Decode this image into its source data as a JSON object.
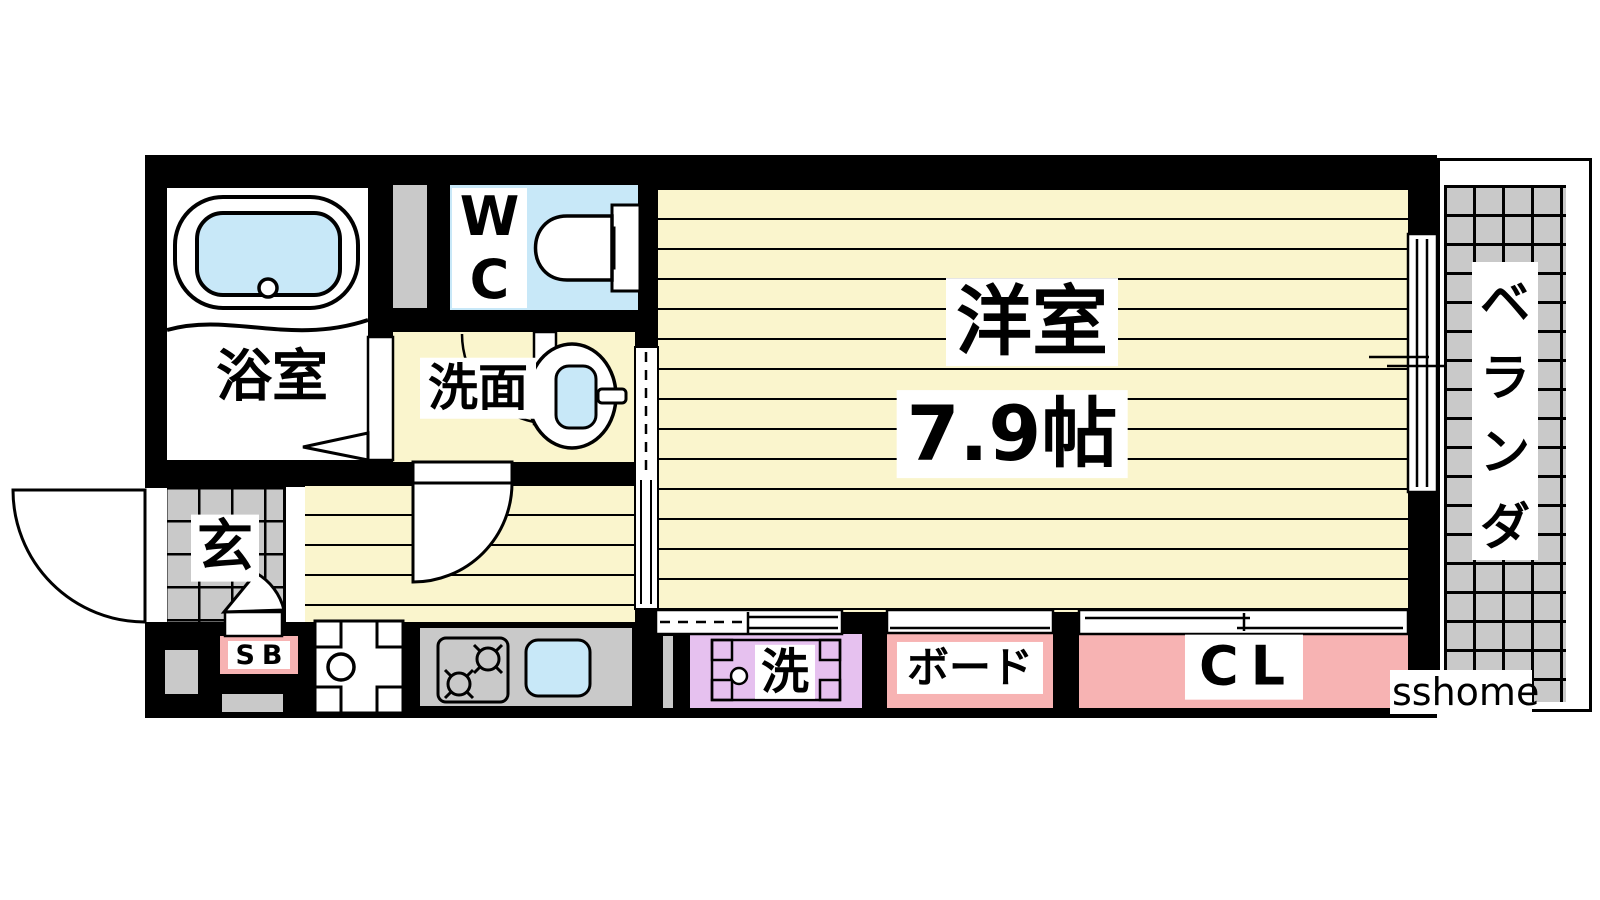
{
  "plan": {
    "watermark": "sshome",
    "rooms": {
      "bathroom": {
        "label": "浴室"
      },
      "toilet": {
        "label": "WC",
        "chars": [
          "W",
          "C"
        ]
      },
      "washroom": {
        "label": "洗面"
      },
      "main_room": {
        "label": "洋室",
        "size": "7.9帖"
      },
      "veranda": {
        "label": "ベランダ",
        "chars": [
          "ベ",
          "ラ",
          "ン",
          "ダ"
        ]
      },
      "entrance": {
        "label": "玄"
      },
      "shoe_box": {
        "label": "SB"
      },
      "laundry": {
        "label": "洗"
      },
      "board": {
        "label": "ボード"
      },
      "closet": {
        "label": "CL"
      }
    },
    "colors": {
      "wall": "#000000",
      "flooring": "#faf5cd",
      "water": "#c8e8f8",
      "tile_gray": "#c9c9c9",
      "laundry_purple": "#e6c1ef",
      "storage_pink": "#f7b3b3"
    }
  }
}
